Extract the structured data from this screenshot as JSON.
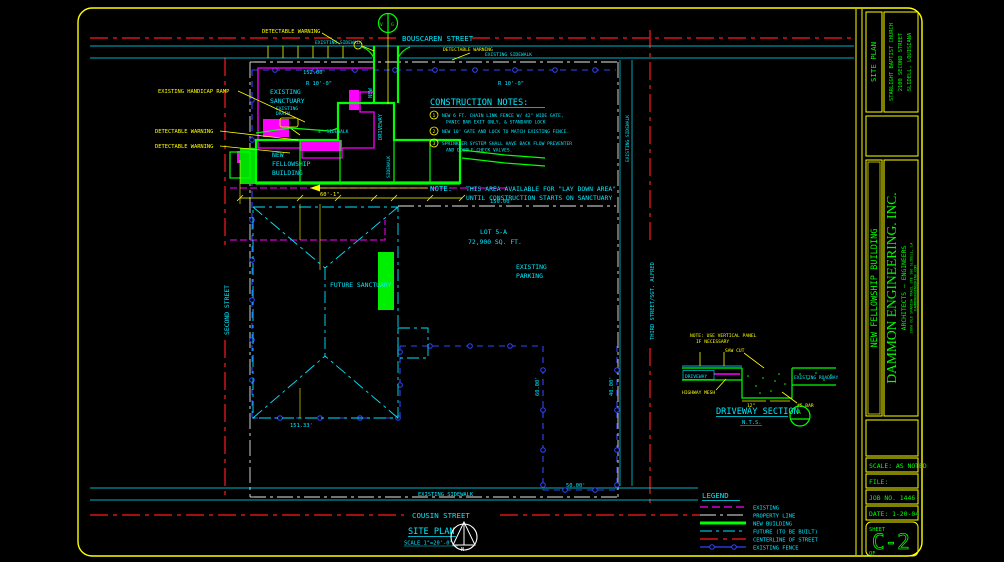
{
  "streets": {
    "top": "BOUSCAREN STREET",
    "bottom": "COUSIN STREET",
    "left": "SECOND STREET",
    "right": "THIRD STREET/SGT. ALFRED"
  },
  "labels": {
    "existing_sidewalk": "EXISTING SIDEWALK",
    "detectable_warning": "DETECTABLE WARNING",
    "existing_handicap_ramp": "EXISTING HANDICAP RAMP",
    "existing_sanctuary_1": "EXISTING",
    "existing_sanctuary_2": "SANCTUARY",
    "existing_drain_1": "EXISTING",
    "existing_drain_2": "DRAIN",
    "new_building_1": "NEW",
    "new_building_2": "FELLOWSHIP",
    "new_building_3": "BUILDING",
    "new_driveway_1": "NEW",
    "new_driveway_2": "DRIVEWAY",
    "sidewalk_4ft": "4' SIDEWALK",
    "sidewalk": "SIDEWALK",
    "future_sanctuary": "FUTURE SANCTUARY",
    "existing_parking_1": "EXISTING",
    "existing_parking_2": "PARKING",
    "lot": "LOT 5-A",
    "lot_area": "72,900 SQ. FT.",
    "valve_v": "V",
    "valve_g": "G"
  },
  "dims": {
    "d152": "152.00'",
    "r10": "R 10'-0\"",
    "d60_1": "60'-1\"",
    "d150": "150.00'",
    "d151": "151.33'",
    "d60": "60.00'",
    "d40": "40.00'",
    "d50": "50.00'"
  },
  "note_callout": {
    "label": "NOTE:",
    "line1": "THIS AREA AVAILABLE FOR \"LAY DOWN AREA\"",
    "line2": "UNTIL CONSTRUCTION STARTS ON SANCTUARY"
  },
  "construction_notes": {
    "title": "CONSTRUCTION NOTES:",
    "items": [
      {
        "num": "1",
        "line1": "NEW 6 FT. CHAIN LINK FENCE W/ 42\" WIDE GATE,",
        "line2": "PANIC BAR EXIT ONLY, & STANDARD LOCK"
      },
      {
        "num": "2",
        "line1": "NEW 10' GATE AND LOCK TO MATCH EXISTING FENCE.",
        "line2": ""
      },
      {
        "num": "3",
        "line1": "SPRINKLER SYSTEM SHALL HAVE BACK FLOW PREVENTER",
        "line2": "AND DOUBLE CHECK VALVES."
      }
    ]
  },
  "driveway_section": {
    "note1": "NOTE: USE VERTICAL PANEL",
    "note2": "IF NECESSARY",
    "saw_cut": "SAW CUT",
    "driveway": "DRIVEWAY",
    "highway_mesh": "HIGHWAY MESH",
    "existing_roadway": "EXISTING ROADWAY",
    "bar": "#5 BAR",
    "d12": "12\"",
    "title": "DRIVEWAY SECTION",
    "scale": "N.T.S.",
    "bubble": "A"
  },
  "legend": {
    "title": "LEGEND",
    "items": [
      {
        "label": "EXISTING"
      },
      {
        "label": "PROPERTY LINE"
      },
      {
        "label": "NEW BUILDING"
      },
      {
        "label": "FUTURE (TO BE BUILT)"
      },
      {
        "label": "CENTERLINE OF STREET"
      },
      {
        "label": "EXISTING FENCE"
      }
    ]
  },
  "site_plan_title": {
    "title": "SITE PLAN",
    "scale": "SCALE 1\"=20'-0\"",
    "north": "N"
  },
  "title_block": {
    "sheet_title": "SITE PLAN",
    "project_line1": "STARLIGHT BAPTIST CHURCH",
    "project_line2": "2100 SECOND STREET",
    "project_line3": "SLIDELL, LOUISIANA",
    "building": "NEW FELLOWSHIP BUILDING",
    "firm_name": "DAMMON ENGINEERING. INC.",
    "firm_type": "ARCHITECTS — ENGINEERS",
    "firm_address": "2000 OLD SPANISH TRAIL STE 100   SLIDELL, LA",
    "firm_web": "DAMMONENGINEERING.COM",
    "scale": "SCALE: AS NOTED",
    "file": "FILE:",
    "job": "JOB NO. 1446",
    "date": "DATE: 1-20-04",
    "sheet_label": "SHEET",
    "sheet_no": "C-2",
    "of": "OF"
  }
}
